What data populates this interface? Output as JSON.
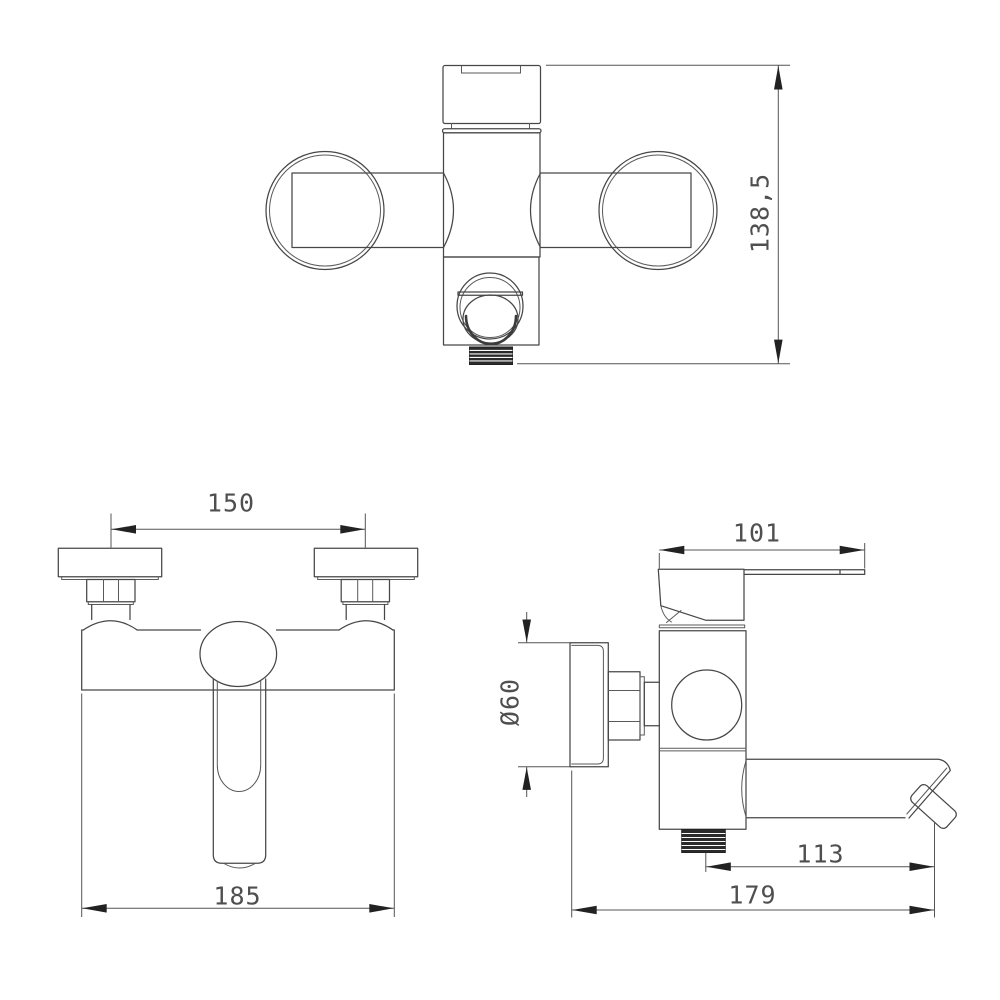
{
  "drawing": {
    "type": "technical-dimension-drawing",
    "subject": "wall-mounted single-lever bath mixer tap",
    "units": "mm",
    "colors": {
      "background": "#ffffff",
      "line": "#474747",
      "dimension_text": "#4f4f4f",
      "arrow": "#222222",
      "thread_fill": "#2b2b2b"
    },
    "views": {
      "top": {
        "name": "top view (plan)"
      },
      "front": {
        "name": "front view"
      },
      "side": {
        "name": "side view"
      }
    },
    "dimensions": {
      "overall_height": {
        "label": "138,5",
        "view": "top",
        "orientation": "vertical"
      },
      "hole_spacing": {
        "label": "150",
        "view": "front",
        "orientation": "horizontal"
      },
      "overall_width": {
        "label": "185",
        "view": "front",
        "orientation": "horizontal"
      },
      "handle_length": {
        "label": "101",
        "view": "side",
        "orientation": "horizontal"
      },
      "flange_diameter": {
        "label": "Ø60",
        "view": "side",
        "orientation": "vertical"
      },
      "spout_reach": {
        "label": "113",
        "view": "side",
        "orientation": "horizontal"
      },
      "overall_depth": {
        "label": "179",
        "view": "side",
        "orientation": "horizontal"
      }
    }
  }
}
